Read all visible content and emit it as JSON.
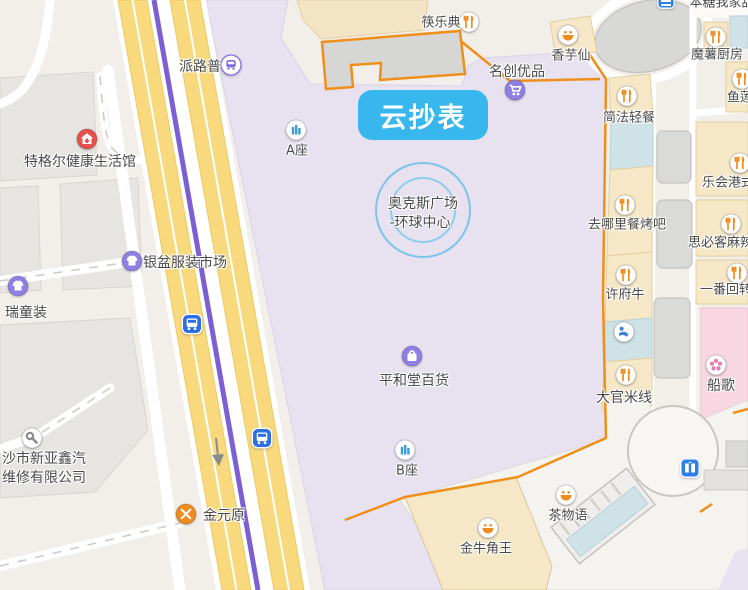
{
  "map": {
    "selected_place_bubble": "云抄表",
    "center_place": {
      "line1": "奥克斯广场",
      "line2": "-环球中心"
    },
    "colors": {
      "mall_area": "#e7e1f0",
      "road_yellow": "#f8d97e",
      "metro_line": "#7c5fd3",
      "boundary_orange": "#ef8f1a",
      "shop_beige": "#f6e8c6",
      "shop_teal": "#cfe2e6",
      "shop_pink": "#f8d7e3",
      "bubble_blue": "#38b7ef",
      "poi_purple": "#8f7fe3",
      "poi_orange": "#f08c1e",
      "poi_red": "#e8514b",
      "transit_blue": "#2f6fe4",
      "highlight_ring": "#7cc5e8"
    },
    "pois": [
      {
        "name": "派路普",
        "type": "metro",
        "x": 231,
        "y": 67,
        "lx": 200,
        "ly": 67,
        "fs": 14
      },
      {
        "name": "特格尔健康生活馆",
        "type": "health",
        "x": 87,
        "y": 141,
        "lx": 80,
        "ly": 162,
        "fs": 14
      },
      {
        "name": "银盆服装市场",
        "type": "clothing",
        "x": 132,
        "y": 263,
        "lx": 185,
        "ly": 263,
        "fs": 14
      },
      {
        "name": "瑞童装",
        "type": "clothing",
        "x": 18,
        "y": 288,
        "lx": 26,
        "ly": 313,
        "fs": 14
      },
      {
        "lines": [
          "沙市新亚鑫汽",
          "维修有限公司"
        ],
        "type": "repair",
        "x": 32,
        "y": 440,
        "lx": 44,
        "ly": 468,
        "fs": 14
      },
      {
        "name": "金元原",
        "type": "crossed-utensils",
        "x": 186,
        "y": 516,
        "lx": 224,
        "ly": 516,
        "fs": 14
      },
      {
        "name": "筷乐典",
        "type": "restaurant",
        "x": 469,
        "y": 24,
        "lx": 441,
        "ly": 24,
        "fs": 13
      },
      {
        "name": "A座",
        "type": "building",
        "x": 296,
        "y": 132,
        "lx": 297,
        "ly": 152,
        "fs": 13
      },
      {
        "name": "B座",
        "type": "building",
        "x": 405,
        "y": 452,
        "lx": 407,
        "ly": 472,
        "fs": 13
      },
      {
        "name": "平和堂百货",
        "type": "shopping-bag",
        "x": 412,
        "y": 358,
        "lx": 414,
        "ly": 381,
        "fs": 14
      },
      {
        "name": "名创优品",
        "type": "shopping-cart",
        "x": 515,
        "y": 92,
        "lx": 517,
        "ly": 72,
        "fs": 14
      },
      {
        "name": "香芋仙",
        "type": "dessert",
        "x": 568,
        "y": 37,
        "lx": 571,
        "ly": 57,
        "fs": 13
      },
      {
        "name": "魔薯厨房",
        "type": "restaurant",
        "x": 716,
        "y": 39,
        "lx": 717,
        "ly": 56,
        "fs": 13
      },
      {
        "name": "本糖我家甜",
        "type": "none",
        "x": 666,
        "y": 2,
        "lx": 722,
        "ly": 4,
        "fs": 13
      },
      {
        "name": "鱼莲",
        "type": "restaurant",
        "x": 742,
        "y": 81,
        "lx": 740,
        "ly": 99,
        "fs": 13
      },
      {
        "name": "简法轻餐",
        "type": "restaurant",
        "x": 627,
        "y": 98,
        "lx": 629,
        "ly": 119,
        "fs": 13
      },
      {
        "name": "乐会港式",
        "type": "restaurant",
        "x": 740,
        "y": 165,
        "lx": 728,
        "ly": 184,
        "fs": 13
      },
      {
        "name": "去哪里餐烤吧",
        "type": "restaurant",
        "x": 625,
        "y": 207,
        "lx": 627,
        "ly": 226,
        "fs": 13
      },
      {
        "name": "思必客麻辣烫",
        "type": "restaurant",
        "x": 731,
        "y": 226,
        "lx": 727,
        "ly": 244,
        "fs": 13
      },
      {
        "name": "许府牛",
        "type": "restaurant",
        "x": 626,
        "y": 277,
        "lx": 625,
        "ly": 296,
        "fs": 13
      },
      {
        "name": "一番回转",
        "type": "restaurant",
        "x": 737,
        "y": 275,
        "lx": 726,
        "ly": 291,
        "fs": 13
      },
      {
        "name": "大官米线",
        "type": "restaurant",
        "x": 626,
        "y": 377,
        "lx": 624,
        "ly": 398,
        "fs": 14
      },
      {
        "name": "船歌",
        "type": "flower",
        "x": 716,
        "y": 367,
        "lx": 721,
        "ly": 386,
        "fs": 14
      },
      {
        "name": "茶物语",
        "type": "dessert",
        "x": 566,
        "y": 497,
        "lx": 568,
        "ly": 517,
        "fs": 13
      },
      {
        "name": "金牛角王",
        "type": "dessert",
        "x": 488,
        "y": 530,
        "lx": 486,
        "ly": 550,
        "fs": 13
      },
      {
        "type": "spa",
        "x": 624,
        "y": 334
      },
      {
        "type": "bus",
        "x": 192,
        "y": 326
      },
      {
        "type": "bus",
        "x": 262,
        "y": 440
      },
      {
        "type": "elevator",
        "x": 690,
        "y": 470
      },
      {
        "type": "poi-blue",
        "x": 666,
        "y": 2
      }
    ]
  }
}
